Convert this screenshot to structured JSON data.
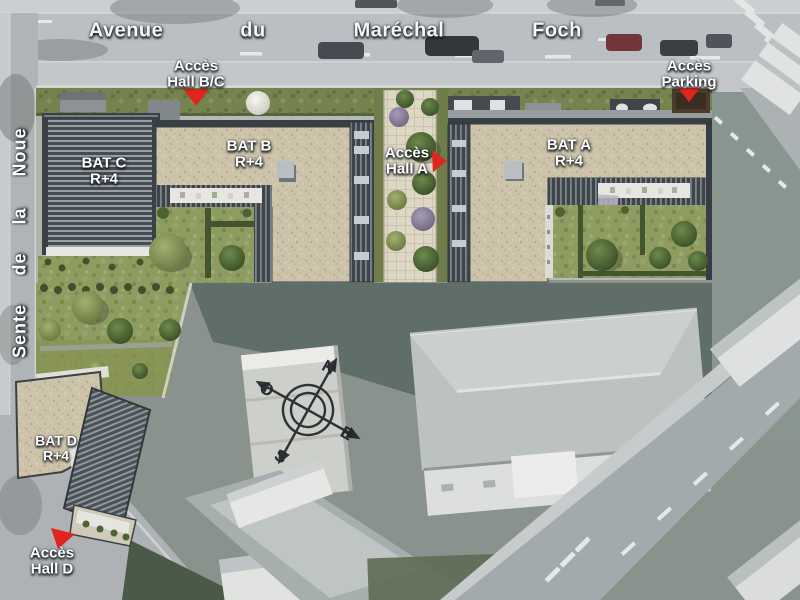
{
  "map": {
    "streets": {
      "avenue_words": [
        "Avenue",
        "du",
        "Maréchal",
        "Foch"
      ],
      "side_street_words": [
        "Noue",
        "la",
        "de",
        "Sente"
      ]
    },
    "buildings": [
      {
        "name": "BAT A",
        "floors": "R+4"
      },
      {
        "name": "BAT B",
        "floors": "R+4"
      },
      {
        "name": "BAT C",
        "floors": "R+4"
      },
      {
        "name": "BAT D",
        "floors": "R+4"
      }
    ],
    "access_points": [
      {
        "line1": "Accès",
        "line2": "Hall B/C"
      },
      {
        "line1": "Accès",
        "line2": "Parking"
      },
      {
        "line1": "Accès",
        "line2": "Hall A"
      },
      {
        "line1": "Accès",
        "line2": "Hall D"
      }
    ],
    "compass": {
      "north": "N",
      "west": "O",
      "east": "E",
      "south": "S"
    },
    "colors": {
      "marker_red": "#e0251c",
      "label_text": "#ffffff"
    }
  }
}
